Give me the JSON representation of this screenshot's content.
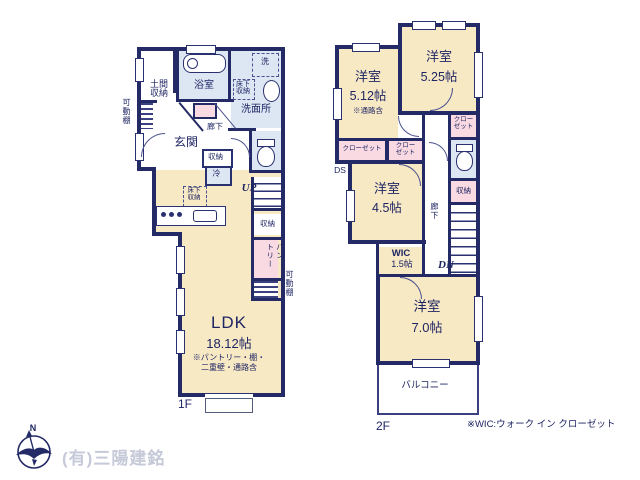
{
  "f1": {
    "floor_label": "1F",
    "doma_l1": "土間",
    "doma_l2": "収納",
    "kadodana_left": "可動棚",
    "bath": "浴室",
    "wash": "洗",
    "yukashita_a_l1": "床下",
    "yukashita_a_l2": "収納",
    "senmenjo": "洗面所",
    "genkan": "玄関",
    "rouka": "廊下",
    "shuno_hall": "収納",
    "rei": "冷",
    "yukashita_b_l1": "床下",
    "yukashita_b_l2": "収納",
    "up": "UP",
    "shuno_stairs": "収納",
    "pantry_l1": "パン",
    "pantry_l2": "トリー",
    "kadodana_right": "可動棚",
    "ldk_name": "LDK",
    "ldk_size": "18.12帖",
    "ldk_note1": "※パントリー・棚・",
    "ldk_note2": "二重壁・通路含"
  },
  "f2": {
    "floor_label": "2F",
    "room512_name": "洋室",
    "room512_size": "5.12帖",
    "room512_note": "※通路含",
    "room525_name": "洋室",
    "room525_size": "5.25帖",
    "room45_name": "洋室",
    "room45_size": "4.5帖",
    "room70_name": "洋室",
    "room70_size": "7.0帖",
    "closet_a": "クローゼット",
    "closet_b_l1": "クロー",
    "closet_b_l2": "ゼット",
    "closet_c_l1": "クロー",
    "closet_c_l2": "ゼット",
    "ds": "DS",
    "rouka": "廊下",
    "shuno_a": "収納",
    "wic_name": "WIC",
    "wic_size": "1.5帖",
    "dn": "DN",
    "balcony": "バルコニー"
  },
  "footer": {
    "company": "(有)三陽建銘",
    "wic_note": "※WIC:ウォーク イン クローゼット",
    "compass_n": "N"
  },
  "colors": {
    "wall": "#232a66",
    "room_cream": "#f8e9c5",
    "room_blue": "#dde7f4",
    "room_pink": "#f9dae3",
    "text_navy": "#1e2563",
    "company_gray": "#c6c9d8"
  }
}
